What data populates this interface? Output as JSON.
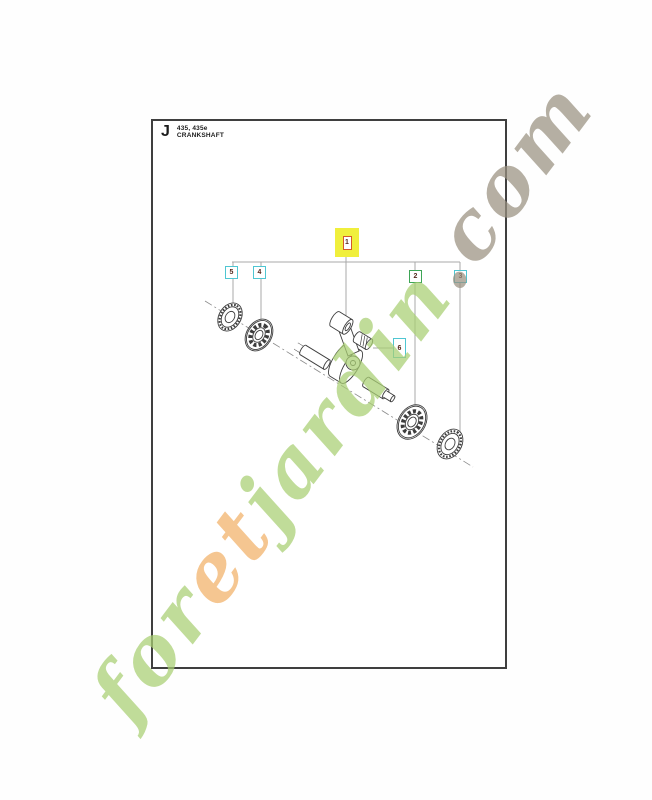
{
  "header": {
    "section_letter": "J",
    "models": "435, 435e",
    "title": "CRANKSHAFT"
  },
  "callouts": {
    "highlighted": {
      "label": "1"
    },
    "items": [
      {
        "label": "5"
      },
      {
        "label": "4"
      },
      {
        "label": "2"
      },
      {
        "label": "3"
      },
      {
        "label": "6"
      }
    ]
  },
  "colors": {
    "callout_cyan_border": "#4fc6d2",
    "callout_green_border": "#3ea556",
    "callout_number": "#54281c",
    "highlight_bg": "#f0ef3c",
    "highlight_inner_border": "#d4582b",
    "sheet_border": "#3f3f3f",
    "callout_line": "#a8a8a8",
    "art_line": "#3d3d3d"
  },
  "watermark": {
    "text": "foretjardin.com",
    "letters": [
      {
        "ch": "f",
        "color": "#a9cf73"
      },
      {
        "ch": "o",
        "color": "#a9cf73"
      },
      {
        "ch": "r",
        "color": "#a9cf73"
      },
      {
        "ch": "e",
        "color": "#f2b168"
      },
      {
        "ch": "t",
        "color": "#f2b168"
      },
      {
        "ch": "j",
        "color": "#a9cf73"
      },
      {
        "ch": "a",
        "color": "#a9cf73"
      },
      {
        "ch": "r",
        "color": "#a9cf73"
      },
      {
        "ch": "d",
        "color": "#a9cf73"
      },
      {
        "ch": "i",
        "color": "#a9cf73"
      },
      {
        "ch": "n",
        "color": "#a9cf73"
      },
      {
        "ch": ".",
        "color": "#9a9181"
      },
      {
        "ch": "c",
        "color": "#9a9181"
      },
      {
        "ch": "o",
        "color": "#9a9181"
      },
      {
        "ch": "m",
        "color": "#9a9181"
      }
    ]
  }
}
